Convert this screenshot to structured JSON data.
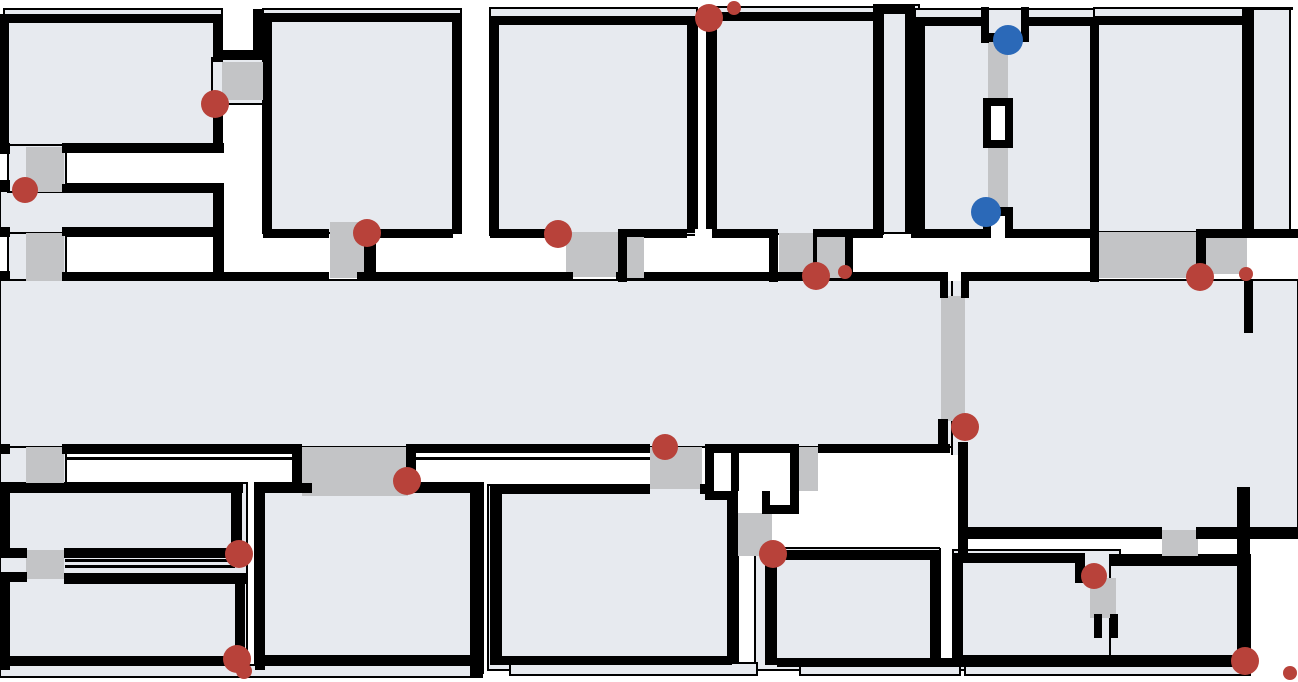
{
  "map": {
    "width": 1298,
    "height": 682,
    "background": "#ffffff",
    "palette": {
      "room_fill": "#e7eaef",
      "room_outline": "#000000",
      "wall": "#000000",
      "doorway_gray": "#c3c4c6",
      "marker_red": "#b8423a",
      "marker_blue": "#2b69b8",
      "white": "#ffffff"
    },
    "layers": [
      {
        "name": "room-region",
        "type": "rects",
        "fill": "#e7eaef",
        "stroke": "#000000",
        "stroke_width": 2,
        "interactable": false,
        "items": [
          [
            4,
            9,
            218,
            137
          ],
          [
            212,
            58,
            56,
            46
          ],
          [
            263,
            9,
            198,
            224
          ],
          [
            0,
            184,
            223,
            52
          ],
          [
            8,
            145,
            58,
            47
          ],
          [
            8,
            233,
            58,
            48
          ],
          [
            490,
            8,
            207,
            227
          ],
          [
            707,
            7,
            176,
            227
          ],
          [
            874,
            5,
            45,
            228
          ],
          [
            915,
            9,
            180,
            223
          ],
          [
            1094,
            8,
            152,
            224
          ],
          [
            1253,
            8,
            37,
            222
          ],
          [
            0,
            280,
            954,
            167
          ],
          [
            952,
            280,
            346,
            258
          ],
          [
            0,
            447,
            66,
            48
          ],
          [
            0,
            483,
            247,
            95
          ],
          [
            0,
            574,
            247,
            100
          ],
          [
            255,
            483,
            228,
            190
          ],
          [
            488,
            485,
            250,
            185
          ],
          [
            755,
            548,
            185,
            122
          ],
          [
            953,
            550,
            167,
            120
          ],
          [
            1110,
            555,
            140,
            115
          ],
          [
            510,
            663,
            247,
            12
          ],
          [
            800,
            663,
            160,
            12
          ],
          [
            965,
            662,
            285,
            13
          ],
          [
            0,
            665,
            482,
            12
          ]
        ]
      },
      {
        "name": "thin-outline",
        "type": "rects",
        "fill": "#000000",
        "stroke": null,
        "stroke_width": 0,
        "interactable": false,
        "items": [
          [
            65,
            559,
            170,
            3
          ],
          [
            65,
            565,
            170,
            3
          ],
          [
            65,
            457,
            238,
            3
          ],
          [
            412,
            457,
            240,
            3
          ],
          [
            1246,
            7,
            47,
            3
          ]
        ]
      },
      {
        "name": "doorway",
        "type": "rects",
        "fill": "#c3c4c6",
        "stroke": null,
        "stroke_width": 0,
        "interactable": false,
        "items": [
          [
            222,
            62,
            41,
            38
          ],
          [
            26,
            147,
            38,
            45
          ],
          [
            26,
            233,
            38,
            48
          ],
          [
            330,
            222,
            34,
            56
          ],
          [
            566,
            232,
            52,
            45
          ],
          [
            779,
            233,
            34,
            44
          ],
          [
            988,
            40,
            20,
            173
          ],
          [
            1099,
            232,
            97,
            46
          ],
          [
            1206,
            237,
            41,
            37
          ],
          [
            302,
            447,
            106,
            49
          ],
          [
            650,
            447,
            52,
            42
          ],
          [
            799,
            447,
            19,
            44
          ],
          [
            729,
            513,
            43,
            43
          ],
          [
            941,
            296,
            24,
            125
          ],
          [
            1162,
            530,
            36,
            28
          ],
          [
            26,
            447,
            38,
            40
          ],
          [
            26,
            550,
            38,
            29
          ],
          [
            1090,
            578,
            26,
            40
          ]
        ]
      },
      {
        "name": "wall-segment",
        "type": "rects",
        "fill": "#000000",
        "stroke": null,
        "stroke_width": 0,
        "interactable": false,
        "items": [
          [
            0,
            14,
            223,
            9
          ],
          [
            0,
            14,
            9,
            132
          ],
          [
            213,
            14,
            10,
            48
          ],
          [
            218,
            50,
            45,
            10
          ],
          [
            253,
            9,
            10,
            50
          ],
          [
            213,
            95,
            10,
            53
          ],
          [
            0,
            143,
            10,
            11
          ],
          [
            62,
            143,
            162,
            10
          ],
          [
            0,
            180,
            10,
            12
          ],
          [
            62,
            184,
            162,
            9
          ],
          [
            62,
            227,
            162,
            9
          ],
          [
            213,
            184,
            11,
            97
          ],
          [
            0,
            227,
            10,
            10
          ],
          [
            0,
            271,
            10,
            10
          ],
          [
            62,
            272,
            267,
            9
          ],
          [
            357,
            272,
            216,
            9
          ],
          [
            616,
            272,
            332,
            9
          ],
          [
            961,
            272,
            136,
            9
          ],
          [
            940,
            281,
            8,
            17
          ],
          [
            961,
            281,
            8,
            17
          ],
          [
            263,
            13,
            199,
            9
          ],
          [
            263,
            13,
            9,
            220
          ],
          [
            452,
            13,
            10,
            220
          ],
          [
            263,
            229,
            66,
            9
          ],
          [
            364,
            229,
            89,
            9
          ],
          [
            364,
            229,
            12,
            52
          ],
          [
            490,
            16,
            9,
            217
          ],
          [
            490,
            16,
            201,
            9
          ],
          [
            687,
            16,
            10,
            217
          ],
          [
            490,
            229,
            77,
            9
          ],
          [
            618,
            229,
            9,
            53
          ],
          [
            618,
            229,
            69,
            9
          ],
          [
            710,
            229,
            68,
            9
          ],
          [
            769,
            229,
            9,
            53
          ],
          [
            703,
            12,
            180,
            9
          ],
          [
            707,
            12,
            10,
            217
          ],
          [
            874,
            5,
            10,
            228
          ],
          [
            905,
            5,
            10,
            228
          ],
          [
            874,
            5,
            41,
            9
          ],
          [
            915,
            17,
            72,
            9
          ],
          [
            915,
            17,
            10,
            215
          ],
          [
            981,
            7,
            8,
            36
          ],
          [
            981,
            33,
            48,
            9
          ],
          [
            1021,
            7,
            8,
            34
          ],
          [
            1025,
            17,
            70,
            9
          ],
          [
            983,
            98,
            30,
            50
          ],
          [
            1090,
            25,
            9,
            257
          ],
          [
            1094,
            16,
            152,
            9
          ],
          [
            1242,
            7,
            10,
            231
          ],
          [
            813,
            229,
            9,
            53
          ],
          [
            813,
            229,
            70,
            9
          ],
          [
            911,
            229,
            79,
            9
          ],
          [
            1004,
            229,
            88,
            9
          ],
          [
            983,
            207,
            8,
            31
          ],
          [
            1005,
            207,
            8,
            31
          ],
          [
            983,
            207,
            30,
            9
          ],
          [
            1196,
            229,
            10,
            52
          ],
          [
            1200,
            229,
            47,
            9
          ],
          [
            1247,
            229,
            51,
            9
          ],
          [
            0,
            444,
            10,
            10
          ],
          [
            62,
            444,
            240,
            10
          ],
          [
            292,
            444,
            10,
            48
          ],
          [
            406,
            444,
            10,
            48
          ],
          [
            406,
            444,
            244,
            9
          ],
          [
            705,
            444,
            94,
            9
          ],
          [
            705,
            444,
            9,
            56
          ],
          [
            790,
            444,
            9,
            70
          ],
          [
            705,
            491,
            33,
            9
          ],
          [
            731,
            444,
            8,
            56
          ],
          [
            762,
            491,
            8,
            23
          ],
          [
            762,
            505,
            37,
            9
          ],
          [
            818,
            444,
            132,
            9
          ],
          [
            938,
            419,
            10,
            34
          ],
          [
            958,
            442,
            10,
            120
          ],
          [
            960,
            527,
            202,
            10
          ],
          [
            1196,
            527,
            102,
            12
          ],
          [
            1237,
            487,
            13,
            180
          ],
          [
            1244,
            280,
            9,
            53
          ],
          [
            0,
            483,
            243,
            10
          ],
          [
            0,
            483,
            10,
            72
          ],
          [
            0,
            548,
            27,
            10
          ],
          [
            0,
            572,
            27,
            10
          ],
          [
            0,
            574,
            10,
            96
          ],
          [
            231,
            489,
            11,
            66
          ],
          [
            64,
            548,
            178,
            10
          ],
          [
            64,
            574,
            182,
            10
          ],
          [
            235,
            574,
            10,
            96
          ],
          [
            0,
            656,
            244,
            10
          ],
          [
            255,
            483,
            57,
            10
          ],
          [
            406,
            483,
            77,
            10
          ],
          [
            255,
            483,
            10,
            187
          ],
          [
            470,
            486,
            12,
            190
          ],
          [
            256,
            655,
            226,
            11
          ],
          [
            490,
            484,
            160,
            10
          ],
          [
            700,
            484,
            35,
            10
          ],
          [
            490,
            484,
            12,
            181
          ],
          [
            727,
            484,
            11,
            180
          ],
          [
            498,
            656,
            234,
            9
          ],
          [
            765,
            550,
            12,
            115
          ],
          [
            770,
            550,
            170,
            10
          ],
          [
            930,
            550,
            10,
            110
          ],
          [
            777,
            658,
            183,
            9
          ],
          [
            953,
            553,
            130,
            10
          ],
          [
            1075,
            553,
            10,
            30
          ],
          [
            953,
            553,
            10,
            110
          ],
          [
            953,
            655,
            167,
            12
          ],
          [
            1094,
            614,
            8,
            24
          ],
          [
            1110,
            614,
            8,
            24
          ],
          [
            1110,
            556,
            133,
            10
          ],
          [
            1110,
            655,
            140,
            12
          ]
        ]
      },
      {
        "name": "white-gap",
        "type": "rects",
        "fill": "#ffffff",
        "stroke": null,
        "stroke_width": 0,
        "interactable": false,
        "items": [
          [
            948,
            262,
            13,
            19
          ],
          [
            695,
            229,
            17,
            16
          ],
          [
            627,
            238,
            142,
            34
          ],
          [
            822,
            238,
            268,
            34
          ],
          [
            991,
            216,
            14,
            22
          ],
          [
            714,
            453,
            17,
            38
          ],
          [
            739,
            453,
            51,
            38
          ],
          [
            738,
            491,
            24,
            22
          ],
          [
            991,
            106,
            14,
            34
          ],
          [
            940,
            455,
            18,
            93
          ]
        ]
      },
      {
        "name": "wall-segment-upper",
        "type": "rects",
        "fill": "#000000",
        "stroke": null,
        "stroke_width": 0,
        "interactable": false,
        "items": [
          [
            843,
            229,
            10,
            49
          ]
        ]
      },
      {
        "name": "doorway-top",
        "type": "rects",
        "fill": "#c3c4c6",
        "stroke": null,
        "stroke_width": 0,
        "interactable": false,
        "items": [
          [
            627,
            237,
            17,
            41
          ],
          [
            817,
            237,
            28,
            41
          ]
        ]
      }
    ],
    "markers": [
      {
        "x": 215,
        "y": 104,
        "r": 14,
        "color": "#b8423a",
        "kind": "red"
      },
      {
        "x": 25,
        "y": 190,
        "r": 13,
        "color": "#b8423a",
        "kind": "red"
      },
      {
        "x": 367,
        "y": 233,
        "r": 14,
        "color": "#b8423a",
        "kind": "red"
      },
      {
        "x": 558,
        "y": 234,
        "r": 14,
        "color": "#b8423a",
        "kind": "red"
      },
      {
        "x": 709,
        "y": 18,
        "r": 14,
        "color": "#b8423a",
        "kind": "red"
      },
      {
        "x": 734,
        "y": 8,
        "r": 7,
        "color": "#b8423a",
        "kind": "red"
      },
      {
        "x": 816,
        "y": 276,
        "r": 14,
        "color": "#b8423a",
        "kind": "red"
      },
      {
        "x": 845,
        "y": 272,
        "r": 7,
        "color": "#b8423a",
        "kind": "red"
      },
      {
        "x": 1200,
        "y": 277,
        "r": 14,
        "color": "#b8423a",
        "kind": "red"
      },
      {
        "x": 1246,
        "y": 274,
        "r": 7,
        "color": "#b8423a",
        "kind": "red"
      },
      {
        "x": 965,
        "y": 427,
        "r": 14,
        "color": "#b8423a",
        "kind": "red"
      },
      {
        "x": 665,
        "y": 447,
        "r": 13,
        "color": "#b8423a",
        "kind": "red"
      },
      {
        "x": 773,
        "y": 554,
        "r": 14,
        "color": "#b8423a",
        "kind": "red"
      },
      {
        "x": 407,
        "y": 481,
        "r": 14,
        "color": "#b8423a",
        "kind": "red"
      },
      {
        "x": 239,
        "y": 554,
        "r": 14,
        "color": "#b8423a",
        "kind": "red"
      },
      {
        "x": 237,
        "y": 659,
        "r": 14,
        "color": "#b8423a",
        "kind": "red"
      },
      {
        "x": 244,
        "y": 671,
        "r": 8,
        "color": "#b8423a",
        "kind": "red"
      },
      {
        "x": 1094,
        "y": 576,
        "r": 13,
        "color": "#b8423a",
        "kind": "red"
      },
      {
        "x": 1245,
        "y": 661,
        "r": 14,
        "color": "#b8423a",
        "kind": "red"
      },
      {
        "x": 1290,
        "y": 673,
        "r": 7,
        "color": "#b8423a",
        "kind": "red"
      },
      {
        "x": 1008,
        "y": 40,
        "r": 15,
        "color": "#2b69b8",
        "kind": "blue"
      },
      {
        "x": 986,
        "y": 212,
        "r": 15,
        "color": "#2b69b8",
        "kind": "blue"
      }
    ]
  }
}
